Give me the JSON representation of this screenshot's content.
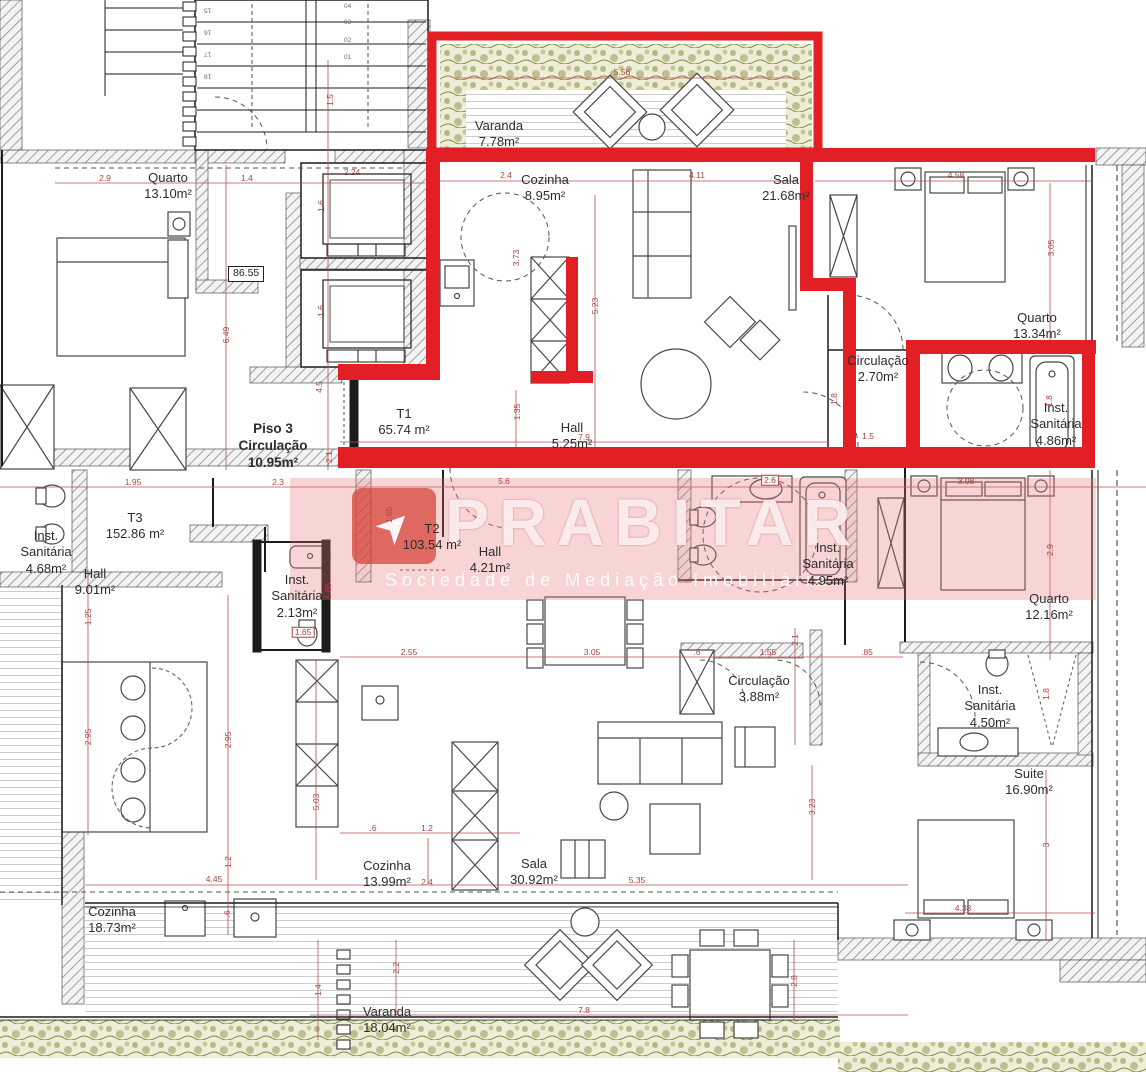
{
  "watermark": {
    "brand": "PRABITAR",
    "subtitle": "Sociedade de Mediação Imobiliária",
    "logo_glyph": "➤"
  },
  "level_marker": "86.55",
  "colors": {
    "unit_highlight": "#e31f26",
    "dimension_red": "#a84444",
    "wall_black": "#1c1c1c",
    "vegetation_green": "#8f9d52",
    "watermark_tint": "rgba(231,112,112,0.30)"
  },
  "rooms": [
    {
      "lines": [
        "Varanda",
        "7.78m²"
      ],
      "x": 499,
      "y": 118,
      "bold": false
    },
    {
      "lines": [
        "Cozinha",
        "8.95m²"
      ],
      "x": 545,
      "y": 172,
      "bold": false
    },
    {
      "lines": [
        "Sala",
        "21.68m²"
      ],
      "x": 786,
      "y": 172,
      "bold": false
    },
    {
      "lines": [
        "Quarto",
        "13.10m²"
      ],
      "x": 168,
      "y": 170,
      "bold": false
    },
    {
      "lines": [
        "Quarto",
        "13.34m²"
      ],
      "x": 1037,
      "y": 310,
      "bold": false
    },
    {
      "lines": [
        "Circulação",
        "2.70m²"
      ],
      "x": 878,
      "y": 353,
      "bold": false
    },
    {
      "lines": [
        "Inst.",
        "Sanitária",
        "4.86m²"
      ],
      "x": 1056,
      "y": 400,
      "bold": false
    },
    {
      "lines": [
        "Piso 3",
        "Circulação",
        "10.95m²"
      ],
      "x": 273,
      "y": 421,
      "bold": true
    },
    {
      "lines": [
        "T1",
        "65.74 m²"
      ],
      "x": 404,
      "y": 406,
      "bold": false
    },
    {
      "lines": [
        "Hall",
        "5.25m²"
      ],
      "x": 572,
      "y": 420,
      "bold": false
    },
    {
      "lines": [
        "T3",
        "152.86 m²"
      ],
      "x": 135,
      "y": 510,
      "bold": false
    },
    {
      "lines": [
        "Inst.",
        "Sanitária",
        "4.68m²"
      ],
      "x": 46,
      "y": 528,
      "bold": false
    },
    {
      "lines": [
        "Hall",
        "9.01m²"
      ],
      "x": 95,
      "y": 566,
      "bold": false
    },
    {
      "lines": [
        "Inst.",
        "Sanitária",
        "2.13m²"
      ],
      "x": 297,
      "y": 572,
      "bold": false
    },
    {
      "lines": [
        "T2",
        "103.54 m²"
      ],
      "x": 432,
      "y": 521,
      "bold": false
    },
    {
      "lines": [
        "Hall",
        "4.21m²"
      ],
      "x": 490,
      "y": 544,
      "bold": false
    },
    {
      "lines": [
        "Inst.",
        "Sanitária",
        "4.95m²"
      ],
      "x": 828,
      "y": 540,
      "bold": false
    },
    {
      "lines": [
        "Quarto",
        "12.16m²"
      ],
      "x": 1049,
      "y": 591,
      "bold": false
    },
    {
      "lines": [
        "Circulação",
        "3.88m²"
      ],
      "x": 759,
      "y": 673,
      "bold": false
    },
    {
      "lines": [
        "Inst.",
        "Sanitária",
        "4.50m²"
      ],
      "x": 990,
      "y": 682,
      "bold": false
    },
    {
      "lines": [
        "Suite",
        "16.90m²"
      ],
      "x": 1029,
      "y": 766,
      "bold": false
    },
    {
      "lines": [
        "Cozinha",
        "13.99m²"
      ],
      "x": 387,
      "y": 858,
      "bold": false
    },
    {
      "lines": [
        "Sala",
        "30.92m²"
      ],
      "x": 534,
      "y": 856,
      "bold": false
    },
    {
      "lines": [
        "Cozinha",
        "18.73m²"
      ],
      "x": 112,
      "y": 904,
      "bold": false
    },
    {
      "lines": [
        "Varanda",
        "18.04m²"
      ],
      "x": 387,
      "y": 1004,
      "bold": false
    }
  ],
  "dimensions": [
    {
      "t": "5.56",
      "x": 622,
      "y": 72
    },
    {
      "t": "2.9",
      "x": 105,
      "y": 178
    },
    {
      "t": "1.4",
      "x": 247,
      "y": 178
    },
    {
      "t": "2.24",
      "x": 352,
      "y": 172
    },
    {
      "t": "1.5",
      "x": 330,
      "y": 100,
      "v": true
    },
    {
      "t": "2.4",
      "x": 506,
      "y": 175
    },
    {
      "t": "4.11",
      "x": 697,
      "y": 175
    },
    {
      "t": "4.58",
      "x": 956,
      "y": 175
    },
    {
      "t": "3.05",
      "x": 1051,
      "y": 248,
      "v": true
    },
    {
      "t": "3.73",
      "x": 516,
      "y": 258,
      "v": true
    },
    {
      "t": "5.23",
      "x": 595,
      "y": 306,
      "v": true
    },
    {
      "t": "1.6",
      "x": 321,
      "y": 206,
      "v": true
    },
    {
      "t": "1.6",
      "x": 321,
      "y": 311,
      "v": true
    },
    {
      "t": "6.49",
      "x": 226,
      "y": 335,
      "v": true
    },
    {
      "t": "4.5",
      "x": 319,
      "y": 387,
      "v": true
    },
    {
      "t": "2.1",
      "x": 329,
      "y": 457,
      "v": true
    },
    {
      "t": "1.35",
      "x": 517,
      "y": 412,
      "v": true
    },
    {
      "t": "7.9",
      "x": 584,
      "y": 437
    },
    {
      "t": "1.95",
      "x": 133,
      "y": 482
    },
    {
      "t": "2.3",
      "x": 278,
      "y": 482
    },
    {
      "t": "5.6",
      "x": 504,
      "y": 481
    },
    {
      "t": "2.6",
      "x": 770,
      "y": 480,
      "boxed": true
    },
    {
      "t": "3.98",
      "x": 966,
      "y": 481
    },
    {
      "t": "1.8",
      "x": 834,
      "y": 399,
      "v": true
    },
    {
      "t": "1.8",
      "x": 1049,
      "y": 401,
      "v": true
    },
    {
      "t": "1.5",
      "x": 868,
      "y": 436
    },
    {
      "t": "1.65",
      "x": 389,
      "y": 515,
      "v": true
    },
    {
      "t": "1.85",
      "x": 328,
      "y": 591,
      "v": true
    },
    {
      "t": "1.65",
      "x": 303,
      "y": 632,
      "boxed": true
    },
    {
      "t": "2.9",
      "x": 1050,
      "y": 550,
      "v": true
    },
    {
      "t": "1.25",
      "x": 88,
      "y": 617,
      "v": true
    },
    {
      "t": "2.55",
      "x": 409,
      "y": 652
    },
    {
      "t": "3.05",
      "x": 592,
      "y": 652
    },
    {
      "t": ".6",
      "x": 697,
      "y": 652
    },
    {
      "t": "1.55",
      "x": 768,
      "y": 652
    },
    {
      "t": ".85",
      "x": 867,
      "y": 652
    },
    {
      "t": "2.1",
      "x": 795,
      "y": 640,
      "v": true
    },
    {
      "t": "1.8",
      "x": 1046,
      "y": 694,
      "v": true
    },
    {
      "t": "2.95",
      "x": 88,
      "y": 737,
      "v": true
    },
    {
      "t": "2.95",
      "x": 228,
      "y": 740,
      "v": true
    },
    {
      "t": "5.03",
      "x": 316,
      "y": 802,
      "v": true
    },
    {
      "t": "3.23",
      "x": 812,
      "y": 807,
      "v": true
    },
    {
      "t": ".6",
      "x": 373,
      "y": 828
    },
    {
      "t": "1.2",
      "x": 427,
      "y": 828
    },
    {
      "t": "2.4",
      "x": 427,
      "y": 882
    },
    {
      "t": "5.35",
      "x": 637,
      "y": 880
    },
    {
      "t": "1.2",
      "x": 228,
      "y": 862,
      "v": true
    },
    {
      "t": ".6",
      "x": 227,
      "y": 914,
      "v": true
    },
    {
      "t": "4.45",
      "x": 214,
      "y": 879
    },
    {
      "t": "1.4",
      "x": 318,
      "y": 990,
      "v": true
    },
    {
      "t": "2.2",
      "x": 396,
      "y": 968,
      "v": true
    },
    {
      "t": "7.8",
      "x": 584,
      "y": 1010
    },
    {
      "t": "2.8",
      "x": 794,
      "y": 981,
      "v": true
    },
    {
      "t": "3",
      "x": 1046,
      "y": 845,
      "v": true
    },
    {
      "t": "4.38",
      "x": 963,
      "y": 908
    }
  ],
  "stair_steps": [
    {
      "t": "15",
      "x": 204,
      "y": 6,
      "flip": true
    },
    {
      "t": "16",
      "x": 204,
      "y": 28,
      "flip": true
    },
    {
      "t": "17",
      "x": 204,
      "y": 50,
      "flip": true
    },
    {
      "t": "18",
      "x": 204,
      "y": 72,
      "flip": true
    },
    {
      "t": "04",
      "x": 344,
      "y": 4,
      "flip": false
    },
    {
      "t": "03",
      "x": 344,
      "y": 20,
      "flip": false
    },
    {
      "t": "02",
      "x": 344,
      "y": 38,
      "flip": false
    },
    {
      "t": "01",
      "x": 344,
      "y": 55,
      "flip": false
    }
  ]
}
